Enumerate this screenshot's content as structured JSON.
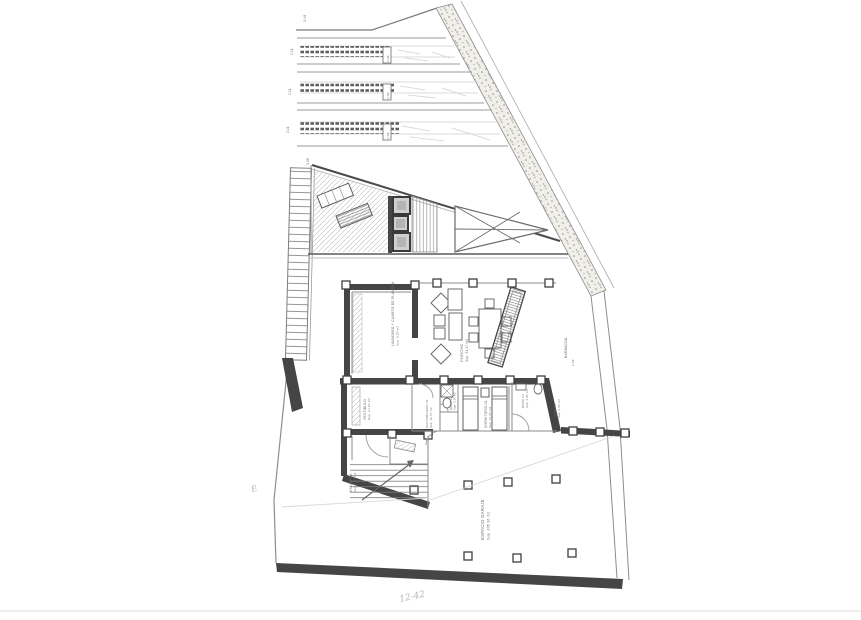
{
  "colors": {
    "paper": "#ffffff",
    "ink": "#5a5a5a",
    "wall": "#454545",
    "stipple_band": "#8f8d86",
    "faint": "#c9c9c9"
  },
  "terraces": {
    "top_label": "3.06",
    "bottom_label": "3.06",
    "strips": [
      {
        "left_label": "2.11",
        "box_label": "3.08"
      },
      {
        "left_label": "2.11",
        "box_label": "3.08"
      },
      {
        "left_label": "2.11",
        "box_label": "3.08"
      }
    ]
  },
  "rooms": {
    "lavadero": {
      "name": "LAVADERO Y CUARTO DE PLANCHA",
      "area": "Sup. 9.50 m2"
    },
    "porche": {
      "name": "PORCHE",
      "area": "Sup. 31.17 m2"
    },
    "barbacoa": {
      "name": "BARBACOA",
      "dim": "2.08"
    },
    "vestibulo": {
      "name": "VESTIBULO",
      "area": "Sup. 13.15 m2"
    },
    "distribuidor": {
      "name": "DISTRIBUIDOR 01",
      "area": "Sup. 10.57 m2"
    },
    "bano2": {
      "name": "BAÑO 02",
      "area": "Sup. 3.30 m2"
    },
    "dormitorio": {
      "name": "DORMITORIO 01",
      "area": "Sup. 13.05 m2"
    },
    "bano1": {
      "name": "BAÑO 01",
      "area": "Sup. 4.85 m2"
    },
    "acceso": {
      "name": "ACCESO",
      "area": "Sup. 4.50 m2"
    },
    "escalera": {
      "name": "ESCALERA",
      "area": "Sup. 4.55 m2"
    },
    "garaje": {
      "name": "ESPACIO GARAJE",
      "area": "Sup. 205.36 m2"
    }
  },
  "annotations": {
    "bottom_mark": "12-42",
    "left_mark": "E"
  }
}
